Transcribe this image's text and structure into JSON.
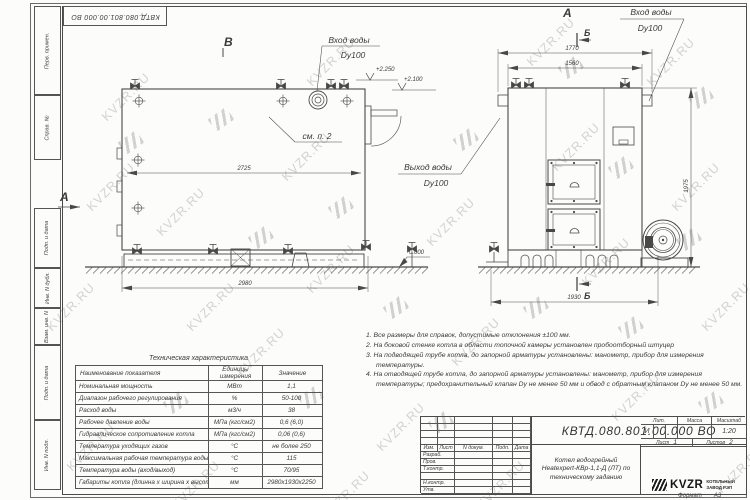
{
  "sheet": {
    "watermark": "KVZR.RU",
    "format_label": "Формат",
    "format_value": "А3",
    "side_labels": [
      "Перв. примен.",
      "Справ. №",
      "Подп. и дата",
      "Инв. N дубл.",
      "Взам. инв. N",
      "Подп. и дата",
      "Инв. N подл."
    ]
  },
  "views": {
    "left": {
      "view_letter": "В",
      "arrow_letter": "А",
      "inlet_label_1": "Вход воды",
      "inlet_label_2": "Dy100",
      "see_note": "см. п. 2",
      "elev_2250": "+2.250",
      "elev_2100": "+2.100",
      "elev_zero": "0.000",
      "outlet_label_1": "Выход воды",
      "outlet_label_2": "Dy100",
      "dim_width_inner": "2725",
      "dim_width": "2980"
    },
    "right": {
      "view_letter": "А",
      "section_letter": "Б",
      "inlet_label_1": "Вход воды",
      "inlet_label_2": "Dy100",
      "dim_top_outer": "1770",
      "dim_top_inner": "1560",
      "dim_height": "1975",
      "dim_width": "1930"
    }
  },
  "tech_table": {
    "title": "Техническая характеристика",
    "col_name": "Наименование показателя",
    "col_units": "Единицы измерения",
    "col_value": "Значение",
    "rows": [
      [
        "Номинальная мощность",
        "МВт",
        "1,1"
      ],
      [
        "Диапазон рабочего регулирования",
        "%",
        "50-100"
      ],
      [
        "Расход воды",
        "м3/ч",
        "38"
      ],
      [
        "Рабочее давление воды",
        "МПа (кгс/см2)",
        "0,6 (6,0)"
      ],
      [
        "Гидравлическое сопротивление котла",
        "МПа (кгс/см2)",
        "0,06 (0,6)"
      ],
      [
        "Температура уходящих газов",
        "°С",
        "не более 250"
      ],
      [
        "Максимальная рабочая температура воды",
        "°С",
        "115"
      ],
      [
        "Температура воды (вход/выход)",
        "°С",
        "70/95"
      ],
      [
        "Габариты котла (длинна х ширина х высота)",
        "мм",
        "2980х1930х2250"
      ]
    ]
  },
  "notes": [
    "1.  Все размеры для справок, допустимые отклонения ±100 мм.",
    "2.  На боковой стенке котла в области топочной камеры установлен пробоотборный штуцер",
    "3.  На подводящей трубе котла, до запорной арматуры установлены: манометр, прибор для измерения температуры.",
    "4.  На отводящей трубе котла, до запорной арматуры установлены: манометр, прибор для измерения температуры; предохранительный клапан Dу не менее 50 мм и обвод с обратным клапаном Dу не менее 50 мм."
  ],
  "title_block": {
    "doc_number": "КВТД.080.801.00.000  ВО",
    "header_cells": [
      "Изм.",
      "Лист",
      "N докум.",
      "Подп.",
      "Дата"
    ],
    "row_labels": [
      "Разраб.",
      "Пров.",
      "Т.контр.",
      "",
      "Н.контр.",
      "Утв."
    ],
    "name_line1": "Котел водогрейный",
    "name_line2": "Heatexpert-КВр-1,1-Д (ЛТ) по",
    "name_line3": "техническому заданию",
    "lit_label": "Лит.",
    "mass_label": "Масса",
    "scale_label": "Масштаб",
    "lit_value": "И",
    "scale_value": "1:20",
    "sheet_label": "Лист",
    "sheet_value": "1",
    "sheets_label": "Листов",
    "sheets_value": "2",
    "logo_text": "KVZR",
    "company_line1": "КОТЕЛЬНЫЙ",
    "company_line2": "ЗАВОД РЭП"
  }
}
